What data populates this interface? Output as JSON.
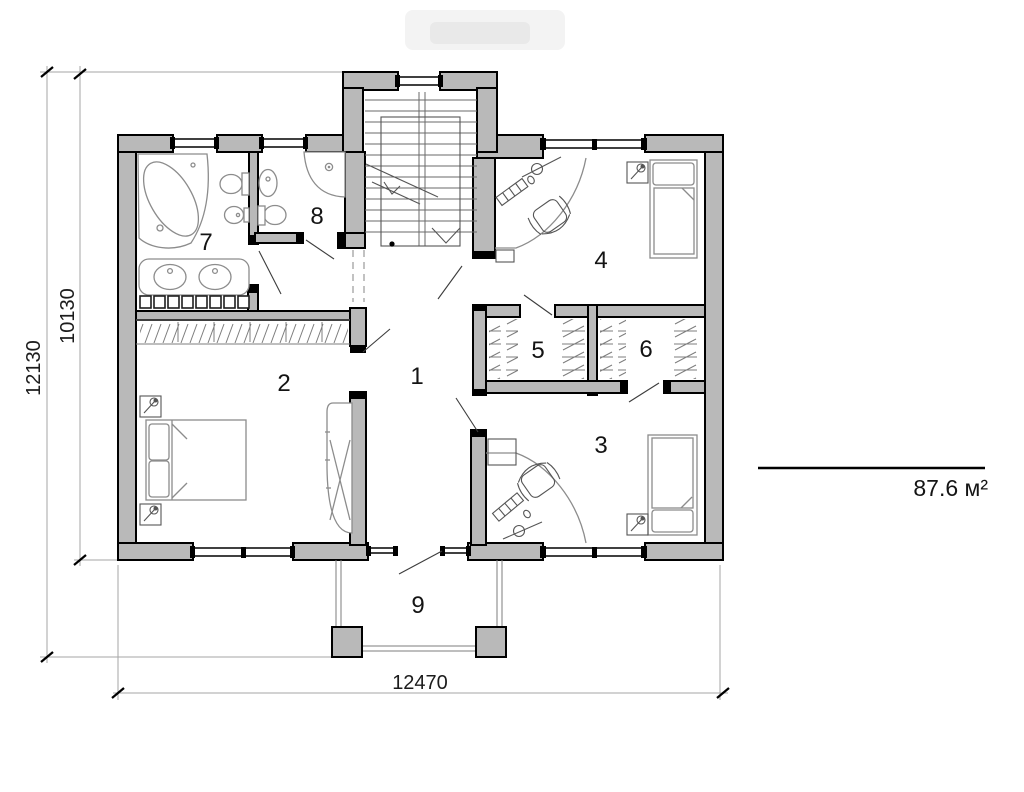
{
  "floor_plan": {
    "room_labels": [
      "1",
      "2",
      "3",
      "4",
      "5",
      "6",
      "7",
      "8",
      "9"
    ],
    "dimensions": {
      "left_outer": "12130",
      "left_inner": "10130",
      "bottom": "12470"
    },
    "area_label": "87.6 м²",
    "colors": {
      "wall_fill": "#b9b9b9",
      "outline": "#000000",
      "furniture": "#8c8c8c",
      "dimension_line": "#a6a6a6"
    }
  }
}
